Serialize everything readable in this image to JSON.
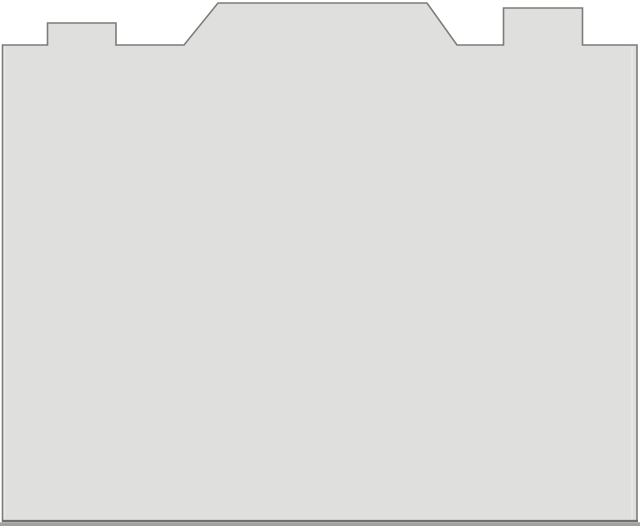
{
  "canvas": {
    "width": 640,
    "height": 526,
    "background_color": "#ffffff"
  },
  "silhouette": {
    "description": "camera-body-style panel outline with left tab, central trapezoid hump and right tab",
    "points": "2.5,45 47.5,45 47.5,23 116,23 116,45 184,45 218,3 427,3 457,45 503.5,45 503.5,8 582.5,8 582.5,45 637,45 637,521 2.5,521",
    "fill_color": "#dfdfdd",
    "stroke_color": "#7c7c7a",
    "stroke_width": "1.6"
  },
  "bottom_strip": {
    "x": "0",
    "y": "522.3",
    "width": "640",
    "height": "3.7",
    "fill_color": "#a1a19f"
  },
  "bottom_edge_line": {
    "x1": "2",
    "y1": "521",
    "x2": "638",
    "y2": "521",
    "stroke_color": "#6f6f6d",
    "stroke_width": "2.2"
  },
  "inner_highlight_left": {
    "x1": "4.6",
    "y1": "47",
    "x2": "4.6",
    "y2": "519",
    "stroke_color": "#eaeae8",
    "stroke_width": "1.4"
  },
  "inner_highlight_right": {
    "x1": "632",
    "y1": "47",
    "x2": "632",
    "y2": "519",
    "stroke_color": "#eaeae8",
    "stroke_width": "1.4"
  }
}
